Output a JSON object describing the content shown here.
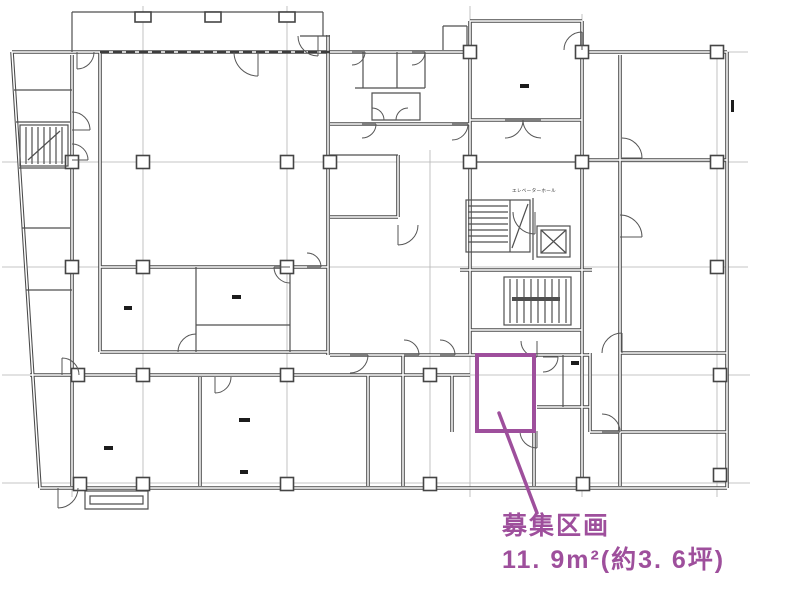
{
  "document": {
    "type": "architectural-floor-plan-scan",
    "background_color": "#ffffff",
    "line_color": "#4a4a4a"
  },
  "annotation": {
    "label": "募集区画",
    "area": "11. 9m²(約3. 6坪)",
    "color": "#9E4F9C"
  },
  "plan_labels": {
    "elevator_hall": "エレベーターホール"
  }
}
